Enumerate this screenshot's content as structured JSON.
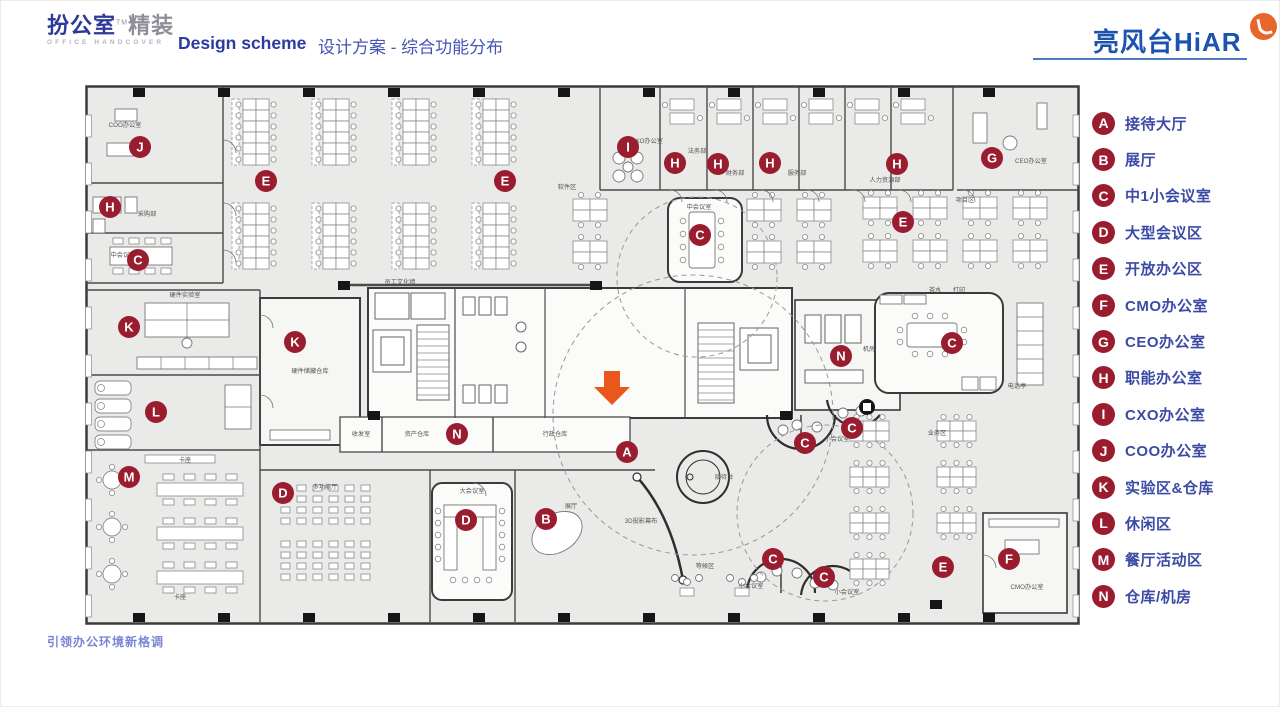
{
  "header": {
    "logo": {
      "brand_bold": "扮公室",
      "brand_light": "精装",
      "tm": "TM",
      "subtitle": "OFFICE HANDCOVER"
    },
    "title_en": "Design scheme",
    "title_zh": "设计方案 - 综合功能分布",
    "right_logo": "亮风台HiAR"
  },
  "footer": {
    "slogan": "引领办公环境新格调"
  },
  "colors": {
    "accent_blue": "#2c3c9e",
    "legend_text": "#3b4aa6",
    "marker_red": "#9a1d2f",
    "arrow_orange": "#e8571c",
    "brand_blue": "#1d53b0",
    "badge_orange": "#e8662c"
  },
  "legend": {
    "items": [
      {
        "letter": "A",
        "label": "接待大厅"
      },
      {
        "letter": "B",
        "label": "展厅"
      },
      {
        "letter": "C",
        "label": "中1小会议室"
      },
      {
        "letter": "D",
        "label": "大型会议区"
      },
      {
        "letter": "E",
        "label": "开放办公区"
      },
      {
        "letter": "F",
        "label": "CMO办公室"
      },
      {
        "letter": "G",
        "label": "CEO办公室"
      },
      {
        "letter": "H",
        "label": "职能办公室"
      },
      {
        "letter": "I",
        "label": "CXO办公室"
      },
      {
        "letter": "J",
        "label": "COO办公室"
      },
      {
        "letter": "K",
        "label": "实验区&仓库"
      },
      {
        "letter": "L",
        "label": "休闲区"
      },
      {
        "letter": "M",
        "label": "餐厅活动区"
      },
      {
        "letter": "N",
        "label": "仓库/机房"
      }
    ]
  },
  "plan": {
    "markers": [
      {
        "letter": "J",
        "x": 55,
        "y": 62
      },
      {
        "letter": "H",
        "x": 25,
        "y": 122
      },
      {
        "letter": "C",
        "x": 53,
        "y": 175
      },
      {
        "letter": "E",
        "x": 181,
        "y": 96
      },
      {
        "letter": "E",
        "x": 420,
        "y": 96
      },
      {
        "letter": "I",
        "x": 543,
        "y": 62
      },
      {
        "letter": "H",
        "x": 590,
        "y": 78
      },
      {
        "letter": "H",
        "x": 633,
        "y": 79
      },
      {
        "letter": "H",
        "x": 685,
        "y": 78
      },
      {
        "letter": "H",
        "x": 812,
        "y": 79
      },
      {
        "letter": "G",
        "x": 907,
        "y": 73
      },
      {
        "letter": "C",
        "x": 615,
        "y": 150
      },
      {
        "letter": "E",
        "x": 818,
        "y": 137
      },
      {
        "letter": "K",
        "x": 44,
        "y": 242
      },
      {
        "letter": "K",
        "x": 210,
        "y": 257
      },
      {
        "letter": "C",
        "x": 867,
        "y": 258
      },
      {
        "letter": "N",
        "x": 756,
        "y": 271
      },
      {
        "letter": "L",
        "x": 71,
        "y": 327
      },
      {
        "letter": "M",
        "x": 44,
        "y": 392
      },
      {
        "letter": "N",
        "x": 372,
        "y": 349
      },
      {
        "letter": "A",
        "x": 542,
        "y": 367
      },
      {
        "letter": "D",
        "x": 198,
        "y": 408
      },
      {
        "letter": "D",
        "x": 381,
        "y": 435
      },
      {
        "letter": "B",
        "x": 461,
        "y": 434
      },
      {
        "letter": "C",
        "x": 720,
        "y": 358
      },
      {
        "letter": "C",
        "x": 767,
        "y": 343
      },
      {
        "letter": "C",
        "x": 688,
        "y": 474
      },
      {
        "letter": "C",
        "x": 739,
        "y": 492
      },
      {
        "letter": "E",
        "x": 858,
        "y": 482
      },
      {
        "letter": "F",
        "x": 924,
        "y": 474
      }
    ],
    "labels": [
      {
        "text": "软件区",
        "x": 482,
        "y": 104
      },
      {
        "text": "项目区",
        "x": 880,
        "y": 117
      },
      {
        "text": "员工文化墙",
        "x": 315,
        "y": 199
      },
      {
        "text": "COO办公室",
        "x": 40,
        "y": 42
      },
      {
        "text": "采购部",
        "x": 62,
        "y": 131
      },
      {
        "text": "中会议室",
        "x": 38,
        "y": 172
      },
      {
        "text": "CXO办公室",
        "x": 562,
        "y": 58
      },
      {
        "text": "法务部",
        "x": 612,
        "y": 68
      },
      {
        "text": "财务部",
        "x": 650,
        "y": 90
      },
      {
        "text": "服务部",
        "x": 712,
        "y": 90
      },
      {
        "text": "人力资源部",
        "x": 800,
        "y": 97
      },
      {
        "text": "CEO办公室",
        "x": 946,
        "y": 78
      },
      {
        "text": "中会议室",
        "x": 614,
        "y": 124
      },
      {
        "text": "茶水",
        "x": 850,
        "y": 207
      },
      {
        "text": "打印",
        "x": 874,
        "y": 207
      },
      {
        "text": "机房",
        "x": 784,
        "y": 266
      },
      {
        "text": "电话亭",
        "x": 932,
        "y": 303
      },
      {
        "text": "硬件实验室",
        "x": 100,
        "y": 212
      },
      {
        "text": "硬件储藏仓库",
        "x": 225,
        "y": 288
      },
      {
        "text": "收发室",
        "x": 276,
        "y": 351
      },
      {
        "text": "资产仓库",
        "x": 332,
        "y": 351
      },
      {
        "text": "行政仓库",
        "x": 470,
        "y": 351
      },
      {
        "text": "卡座",
        "x": 100,
        "y": 377
      },
      {
        "text": "卡座",
        "x": 95,
        "y": 514
      },
      {
        "text": "多功能厅",
        "x": 240,
        "y": 404
      },
      {
        "text": "大会议室",
        "x": 387,
        "y": 408
      },
      {
        "text": "展厅",
        "x": 486,
        "y": 423
      },
      {
        "text": "3D投影幕布",
        "x": 556,
        "y": 438
      },
      {
        "text": "接待台",
        "x": 639,
        "y": 394
      },
      {
        "text": "等候区",
        "x": 620,
        "y": 483
      },
      {
        "text": "小会议室",
        "x": 752,
        "y": 356
      },
      {
        "text": "小会议室",
        "x": 666,
        "y": 503
      },
      {
        "text": "小会议室",
        "x": 762,
        "y": 509
      },
      {
        "text": "业务区",
        "x": 852,
        "y": 350
      },
      {
        "text": "CMO办公室",
        "x": 942,
        "y": 504
      }
    ]
  }
}
